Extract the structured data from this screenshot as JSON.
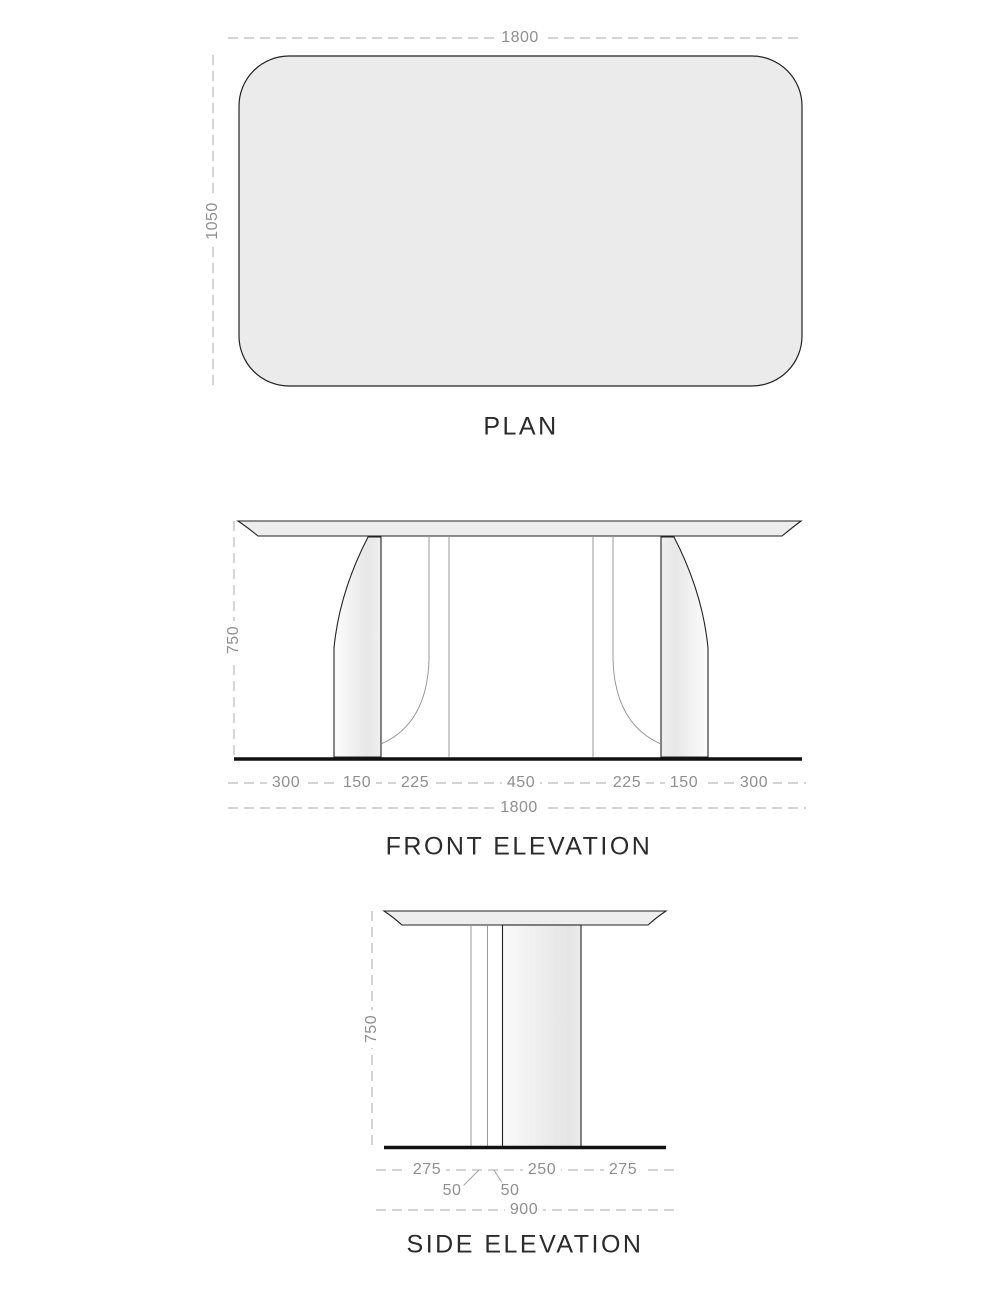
{
  "plan": {
    "title": "PLAN",
    "width_dim": "1800",
    "depth_dim": "1050"
  },
  "front_elevation": {
    "title": "FRONT ELEVATION",
    "height_dim": "750",
    "segment_dims": [
      "300",
      "150",
      "225",
      "450",
      "225",
      "150",
      "300"
    ],
    "overall_dim": "1800"
  },
  "side_elevation": {
    "title": "SIDE ELEVATION",
    "height_dim": "750",
    "segment_dims": [
      "275",
      "250",
      "275"
    ],
    "leg_thickness_dims": [
      "50",
      "50"
    ],
    "overall_dim": "900"
  },
  "colors": {
    "outline": "#222222",
    "surface_fill": "#ebebeb",
    "tabletop_fill": "#ededed",
    "dim_text": "#8f8f8f",
    "dim_line": "#a8a8a8",
    "floor": "#111111"
  }
}
